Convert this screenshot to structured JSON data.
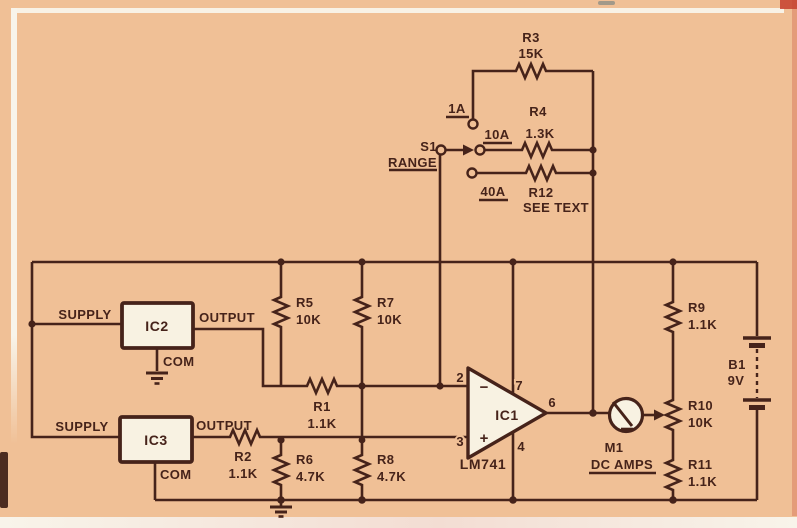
{
  "colors": {
    "background": "#f0c096",
    "ink": "#46231a",
    "paper": "#f8f2e2"
  },
  "components": {
    "r1": {
      "ref": "R1",
      "value": "1.1K"
    },
    "r2": {
      "ref": "R2",
      "value": "1.1K"
    },
    "r3": {
      "ref": "R3",
      "value": "15K"
    },
    "r4": {
      "ref": "R4",
      "value": "1.3K"
    },
    "r5": {
      "ref": "R5",
      "value": "10K"
    },
    "r6": {
      "ref": "R6",
      "value": "4.7K"
    },
    "r7": {
      "ref": "R7",
      "value": "10K"
    },
    "r8": {
      "ref": "R8",
      "value": "4.7K"
    },
    "r9": {
      "ref": "R9",
      "value": "1.1K"
    },
    "r10": {
      "ref": "R10",
      "value": "10K"
    },
    "r11": {
      "ref": "R11",
      "value": "1.1K"
    },
    "r12": {
      "ref": "R12",
      "value": "SEE TEXT"
    }
  },
  "opamp": {
    "ref": "IC1",
    "part": "LM741",
    "pin_inverting": "2",
    "pin_noninverting": "3",
    "pin_vplus": "7",
    "pin_vminus": "4",
    "pin_output": "6",
    "inverting_sign": "−",
    "noninverting_sign": "+"
  },
  "ic2": {
    "ref": "IC2",
    "pin_supply": "SUPPLY",
    "pin_output": "OUTPUT",
    "pin_com": "COM"
  },
  "ic3": {
    "ref": "IC3",
    "pin_supply": "SUPPLY",
    "pin_output": "OUTPUT",
    "pin_com": "COM"
  },
  "switch": {
    "ref": "S1",
    "label": "RANGE",
    "positions": [
      "1A",
      "10A",
      "40A"
    ]
  },
  "meter": {
    "ref": "M1",
    "label": "DC AMPS"
  },
  "battery": {
    "ref": "B1",
    "value": "9V"
  }
}
